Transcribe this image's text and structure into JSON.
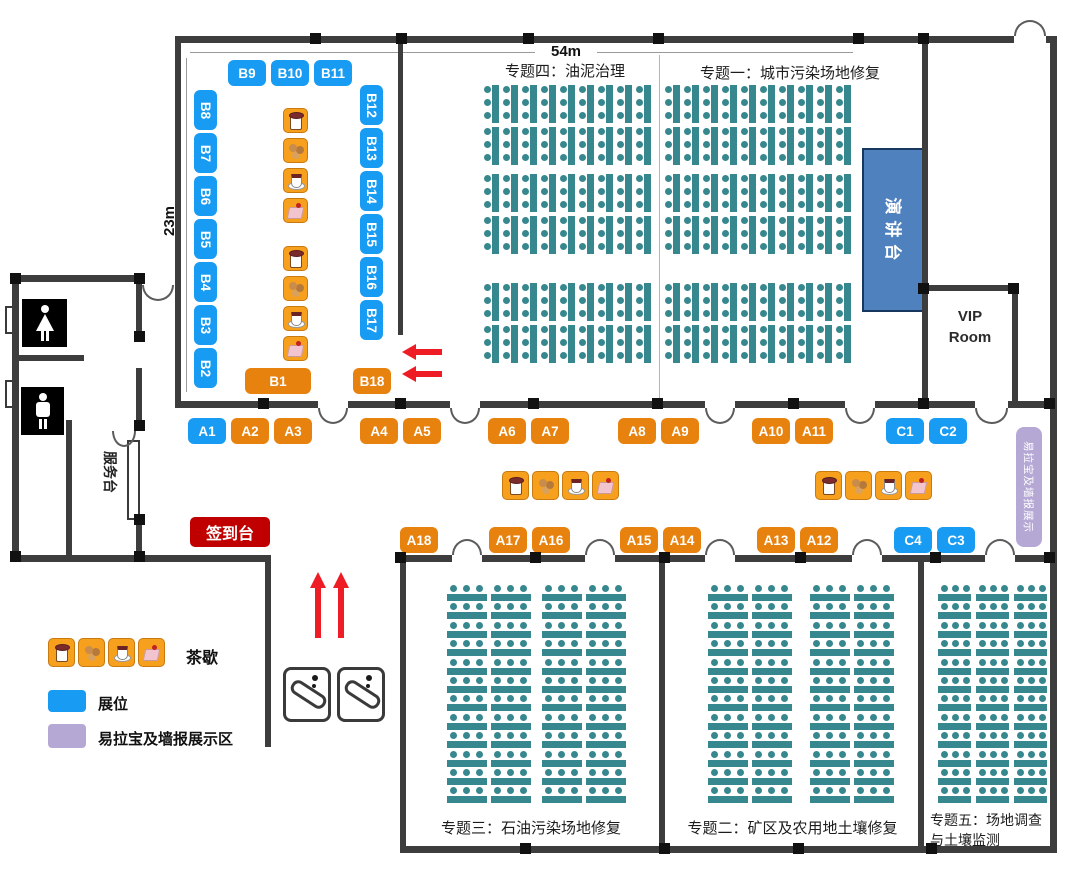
{
  "labels": {
    "dim_width": "54m",
    "dim_height": "23m",
    "topic4": "专题四：油泥治理",
    "topic1": "专题一：城市污染场地修复",
    "topic3": "专题三：石油污染场地修复",
    "topic2": "专题二：矿区及农用地土壤修复",
    "topic5_line1": "专题五：场地调查",
    "topic5_line2": "与土壤监测",
    "podium": "演讲台",
    "vip_line1": "VIP",
    "vip_line2": "Room",
    "service_desk": "服务台",
    "signin_desk": "签到台",
    "banner_right": "易拉宝及墙报展示"
  },
  "legend": {
    "tea_label": "茶歇",
    "booth_label": "展位",
    "banner_label": "易拉宝及墙报展示区"
  },
  "icons": {
    "tea_set": [
      "mug-icon",
      "puffs-icon",
      "coffee-icon",
      "cake-icon"
    ],
    "restroom_female": "female-icon",
    "restroom_male": "male-icon",
    "escalator": "escalator-icon",
    "arrows_up": "up-arrow",
    "arrows_left": "left-arrow"
  },
  "booths": {
    "b_top": [
      {
        "label": "B9",
        "color": "blue"
      },
      {
        "label": "B10",
        "color": "blue"
      },
      {
        "label": "B11",
        "color": "blue"
      }
    ],
    "b_left": [
      {
        "label": "B8",
        "color": "blue"
      },
      {
        "label": "B7",
        "color": "blue"
      },
      {
        "label": "B6",
        "color": "blue"
      },
      {
        "label": "B5",
        "color": "blue"
      },
      {
        "label": "B4",
        "color": "blue"
      },
      {
        "label": "B3",
        "color": "blue"
      },
      {
        "label": "B2",
        "color": "blue"
      }
    ],
    "b_right": [
      {
        "label": "B12",
        "color": "blue"
      },
      {
        "label": "B13",
        "color": "blue"
      },
      {
        "label": "B14",
        "color": "blue"
      },
      {
        "label": "B15",
        "color": "blue"
      },
      {
        "label": "B16",
        "color": "blue"
      },
      {
        "label": "B17",
        "color": "blue"
      }
    ],
    "b_bottom": [
      {
        "label": "B1",
        "color": "orange",
        "w": 66
      },
      {
        "label": "B18",
        "color": "orange"
      }
    ],
    "row1_g1": [
      {
        "label": "A1",
        "color": "blue"
      },
      {
        "label": "A2",
        "color": "orange"
      },
      {
        "label": "A3",
        "color": "orange"
      }
    ],
    "row1_g2": [
      {
        "label": "A4",
        "color": "orange"
      },
      {
        "label": "A5",
        "color": "orange"
      }
    ],
    "row1_g3": [
      {
        "label": "A6",
        "color": "orange"
      },
      {
        "label": "A7",
        "color": "orange"
      }
    ],
    "row1_g4": [
      {
        "label": "A8",
        "color": "orange"
      },
      {
        "label": "A9",
        "color": "orange"
      }
    ],
    "row1_g5": [
      {
        "label": "A10",
        "color": "orange"
      },
      {
        "label": "A11",
        "color": "orange"
      }
    ],
    "row1_g6": [
      {
        "label": "C1",
        "color": "blue"
      },
      {
        "label": "C2",
        "color": "blue"
      }
    ],
    "row2_g1": [
      {
        "label": "A18",
        "color": "orange"
      }
    ],
    "row2_g2": [
      {
        "label": "A17",
        "color": "orange"
      },
      {
        "label": "A16",
        "color": "orange"
      }
    ],
    "row2_g3": [
      {
        "label": "A15",
        "color": "orange"
      },
      {
        "label": "A14",
        "color": "orange"
      }
    ],
    "row2_g4": [
      {
        "label": "A13",
        "color": "orange"
      },
      {
        "label": "A12",
        "color": "orange"
      }
    ],
    "row2_g5": [
      {
        "label": "C4",
        "color": "blue"
      },
      {
        "label": "C3",
        "color": "blue"
      }
    ]
  },
  "seating": {
    "chairs_per_table": 3,
    "hall_band_left": {
      "rows": 2,
      "cols": 9,
      "type": "v"
    },
    "hall_band_right": {
      "rows": 2,
      "cols": 10,
      "type": "v"
    },
    "hall_bands_per_side": 3,
    "room3_group": {
      "rows": 12,
      "cols": 2,
      "type": "h"
    },
    "room2_group": {
      "rows": 12,
      "cols": 2,
      "type": "h"
    },
    "room5_group": {
      "rows": 12,
      "cols": 3,
      "type": "h"
    }
  },
  "colors": {
    "booth_blue": "#189bf2",
    "booth_orange": "#e8820e",
    "badge_red": "#c00000",
    "seat_teal": "#37888e",
    "banner_purple": "#b5a8d5",
    "podium_blue": "#4e81bd",
    "wall": "#3d3d3d",
    "arrow_red": "#ee1c25",
    "icon_tile": "#f7a01d"
  }
}
